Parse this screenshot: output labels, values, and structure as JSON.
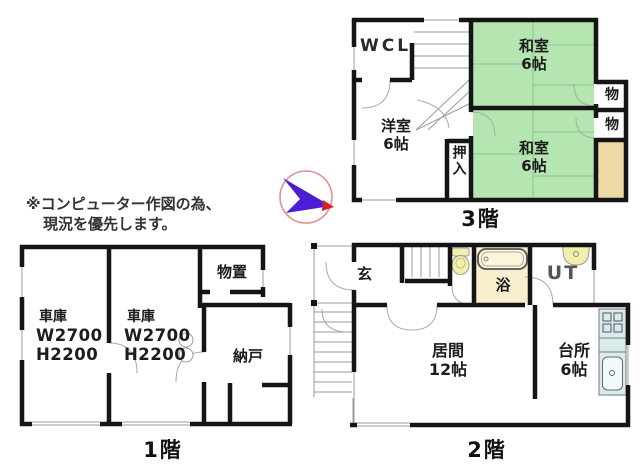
{
  "note": {
    "line1": "※コンピューター作図の為、",
    "line2": "現況を優先します。"
  },
  "floor3": {
    "label": "3階",
    "wcl": "WCL",
    "yoshitsu_name": "洋室",
    "yoshitsu_size": "6帖",
    "washitsu_top_name": "和室",
    "washitsu_top_size": "6帖",
    "washitsu_bottom_name": "和室",
    "washitsu_bottom_size": "6帖",
    "oshiire": "押入",
    "storage_top": "物",
    "storage_bottom": "物"
  },
  "floor2": {
    "label": "2階",
    "genkan": "玄",
    "bath": "浴",
    "utility": "UT",
    "living_name": "居間",
    "living_size": "12帖",
    "kitchen_name": "台所",
    "kitchen_size": "6帖"
  },
  "floor1": {
    "label": "1階",
    "garage_left_name": "車庫",
    "garage_left_w": "W2700",
    "garage_left_h": "H2200",
    "garage_right_name": "車庫",
    "garage_right_w": "W2700",
    "garage_right_h": "H2200",
    "monooki": "物置",
    "nando": "納戸"
  },
  "colors": {
    "tatami_green": "#b5e6b2",
    "balcony_tan": "#eed8a3",
    "bath_cream": "#f9efcf",
    "fixture_yellow": "#f2efae",
    "kitchen_cyan": "#d9ecea",
    "wall_black": "#151515",
    "compass_arrow_purple": "#4c1fd6",
    "compass_ring_pink": "#e09090",
    "compass_tip_red": "#d42222"
  }
}
